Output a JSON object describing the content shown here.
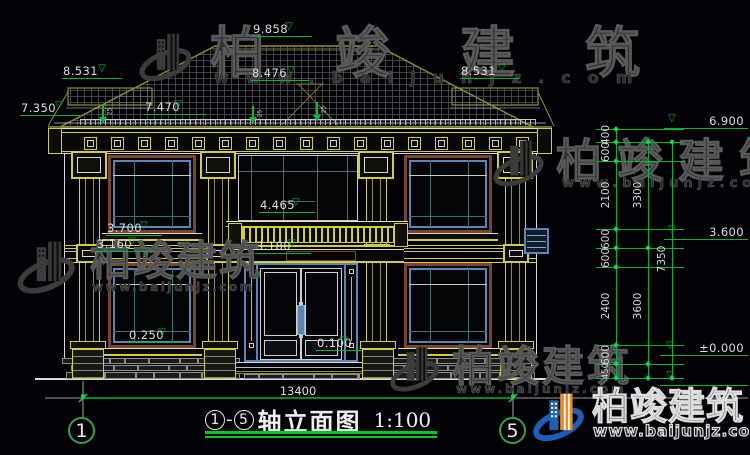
{
  "drawing": {
    "title": {
      "axis_from": "1",
      "axis_to": "5",
      "dash": "-",
      "name": "轴立面图",
      "scale": "1:100"
    },
    "axis_bubbles": {
      "left": "1",
      "right": "5"
    },
    "elevations": {
      "m9858": "9.858",
      "m8531L": "8.531",
      "m8531R": "8.531",
      "m8476": "8.476",
      "m7470": "7.470",
      "m7350": "7.350",
      "m6900": "6.900",
      "m4465": "4.465",
      "m3700": "3.700",
      "m3160": "3.160",
      "m3180": "3.180",
      "m3600": "3.600",
      "m0250": "0.250",
      "m0100": "0.100",
      "m0000": "±0.000"
    },
    "dims": {
      "total_width": "13400",
      "right_inner": [
        "400",
        "600",
        "2100",
        "600",
        "600",
        "2400",
        "600",
        "450"
      ],
      "right_mid": [
        "3300",
        "3600"
      ],
      "right_outer": [
        "7350"
      ]
    },
    "roof": {
      "slope_label": "25"
    }
  },
  "watermark": {
    "brand": "柏竣建筑",
    "site": "www.baijunjz.com"
  },
  "colors": {
    "background": "#020206",
    "cad_yellow": "#cfcf3a",
    "cad_olive": "#8f8f2d",
    "cad_green": "#00b836",
    "cad_white": "#d9d9d9",
    "steel_blue": "#5b85b5",
    "mullion_teal": "#3f7070",
    "frame_brown": "#7c4330",
    "watermark_grey": "#3a3a3a",
    "logo_blue": "#1a5fb8",
    "logo_orange": "#f08a1d"
  }
}
